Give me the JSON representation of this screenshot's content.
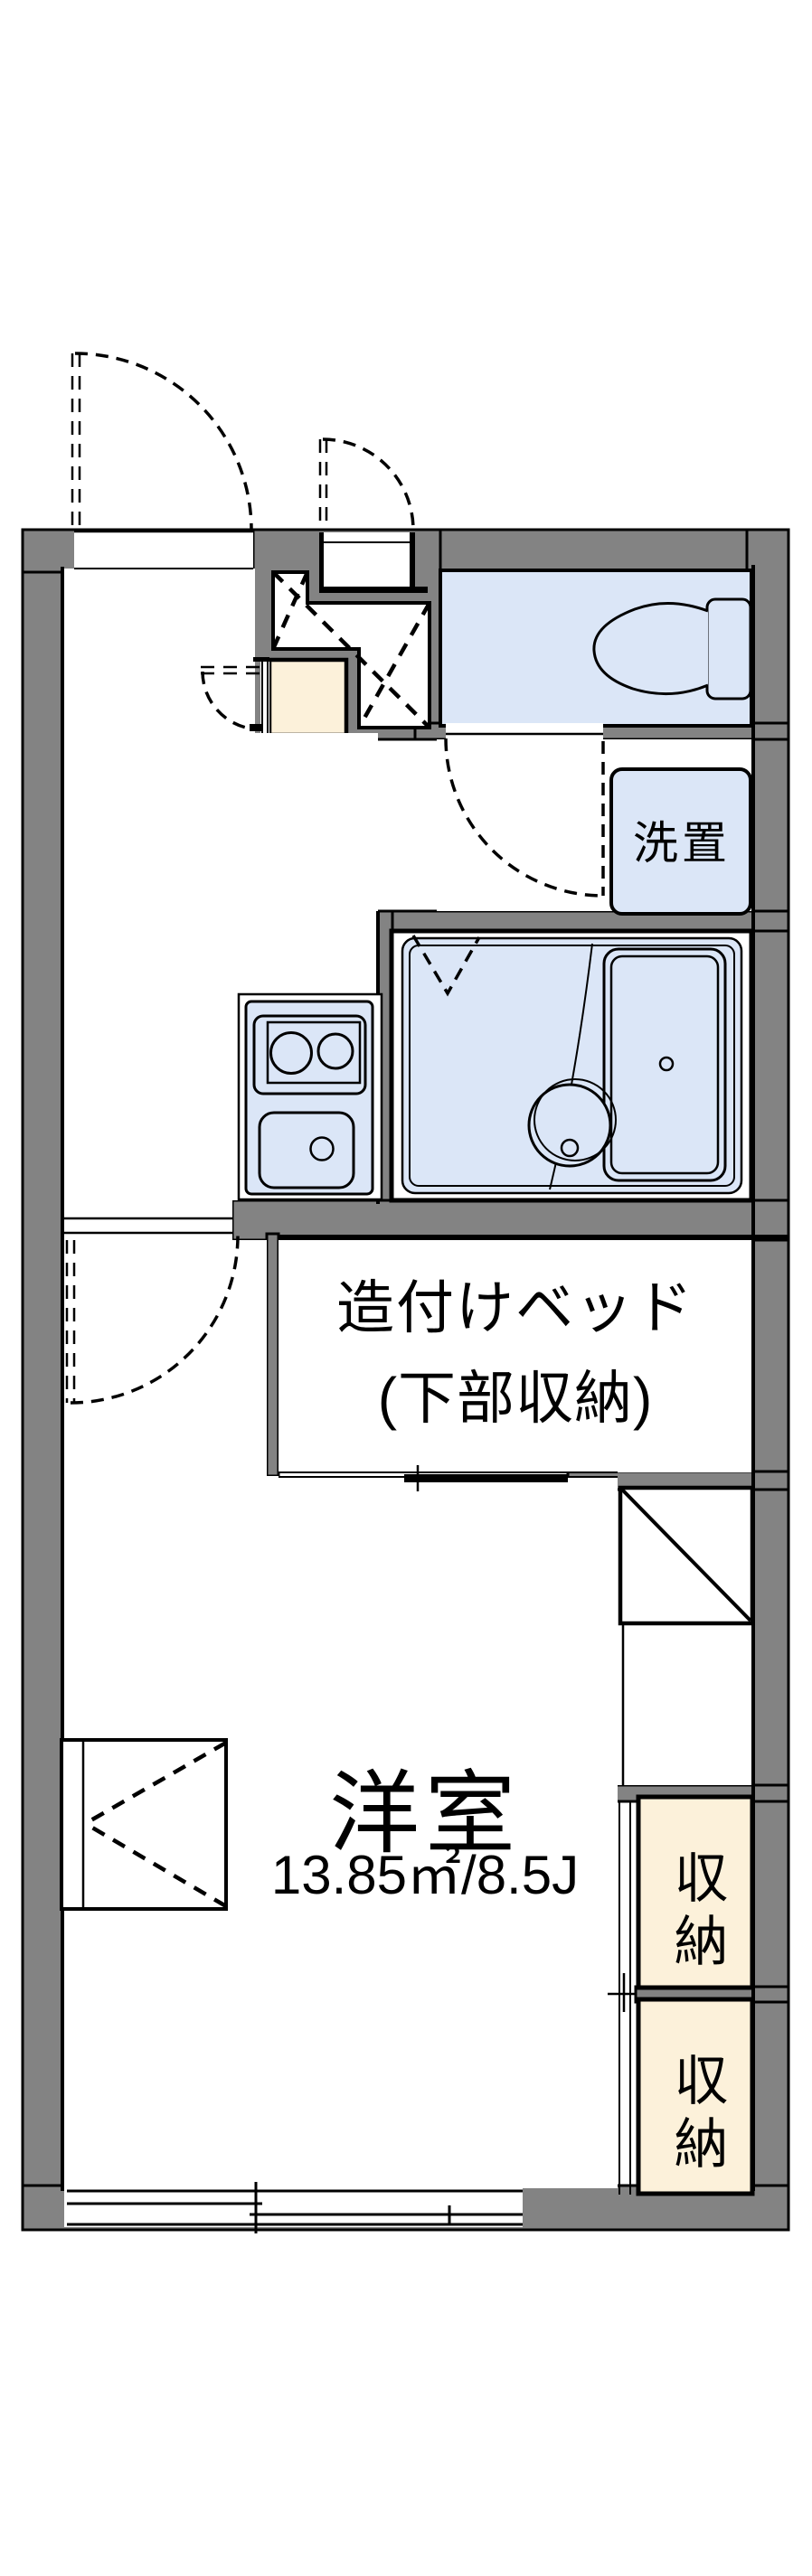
{
  "plan": {
    "title": "apartment-floor-plan",
    "colors": {
      "wall": "#838383",
      "blue": "#dbe6f7",
      "cream": "#fcf1da",
      "ink": "#000000",
      "bg": "#ffffff"
    },
    "rooms": {
      "western_room": {
        "label": "洋室",
        "size": "13.85㎡/8.5J"
      },
      "built_in_bed": {
        "label_line1": "造付けベッド",
        "label_line2": "(下部収納)"
      },
      "washer_place": {
        "label": "洗置"
      },
      "storage_upper": {
        "label": "収納"
      },
      "storage_lower": {
        "label": "収納"
      }
    },
    "icons": [
      "toilet-icon",
      "bathtub-icon",
      "bath-drain-icon",
      "stove-burners-icon",
      "kitchen-sink-icon",
      "refrigerator-space-icon",
      "door-swing-icon",
      "sliding-window-icon",
      "bay-window-icon",
      "shoe-cabinet-icon"
    ]
  }
}
